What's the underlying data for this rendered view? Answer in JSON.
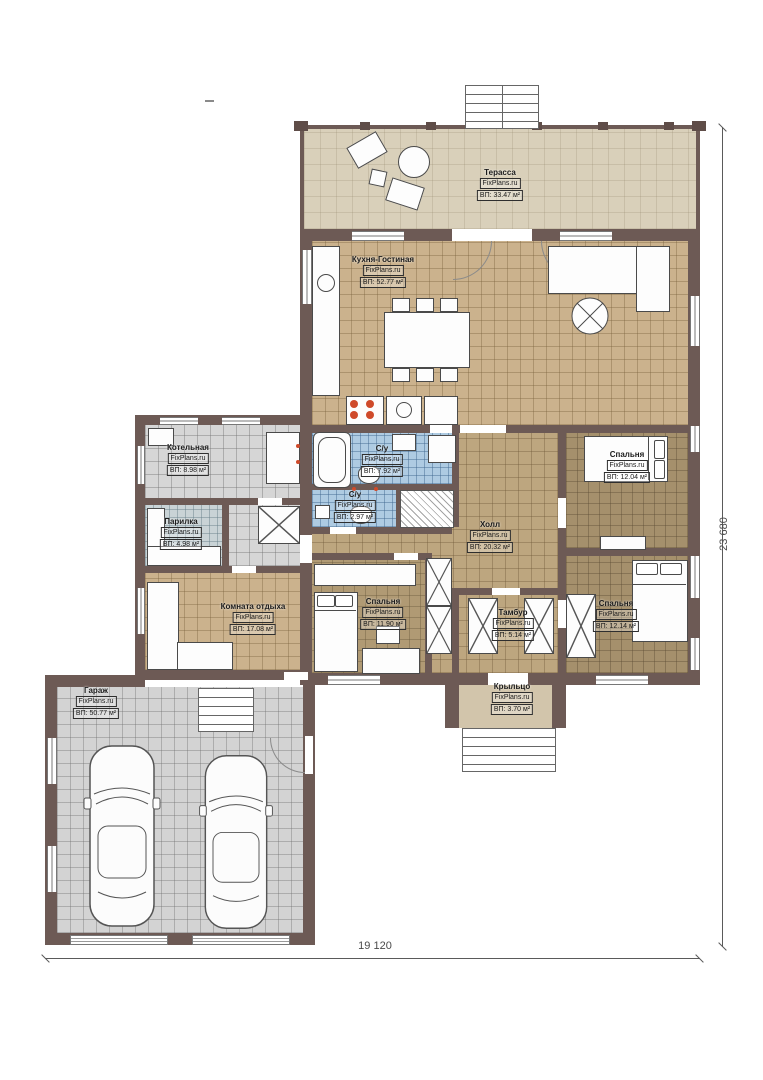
{
  "plan": {
    "watermark": "FixPlans.ru",
    "rooms": [
      {
        "name": "Терасса",
        "area": "ВП: 33.47 м²"
      },
      {
        "name": "Кухня-Гостиная",
        "area": "ВП: 52.77 м²"
      },
      {
        "name": "Котельная",
        "area": "ВП: 8.98 м²"
      },
      {
        "name": "С/у",
        "area": "ВП: 7.92 м²"
      },
      {
        "name": "С/у",
        "area": "ВП: 2.97 м²"
      },
      {
        "name": "Парилка",
        "area": "ВП: 4.98 м²"
      },
      {
        "name": "Холл",
        "area": "ВП: 20.32 м²"
      },
      {
        "name": "Спальня",
        "area": "ВП: 12.04 м²"
      },
      {
        "name": "Комната отдыха",
        "area": "ВП: 17.08 м²"
      },
      {
        "name": "Спальня",
        "area": "ВП: 11.90 м²"
      },
      {
        "name": "Тамбур",
        "area": "ВП: 5.14 м²"
      },
      {
        "name": "Спальня",
        "area": "ВП: 12.14 м²"
      },
      {
        "name": "Крыльцо",
        "area": "ВП: 3.70 м²"
      },
      {
        "name": "Гараж",
        "area": "ВП: 50.77 м²"
      }
    ],
    "dimensions": {
      "width_label": "19 120",
      "height_label": "23 680"
    },
    "colors": {
      "wall": "#6d5a55",
      "floor_tan": "#cbb28d",
      "floor_blue": "#aecbe2",
      "floor_gray": "#d6d6d6",
      "terrace": "#d9d0ba",
      "burner_red": "#cf4a2a"
    }
  }
}
